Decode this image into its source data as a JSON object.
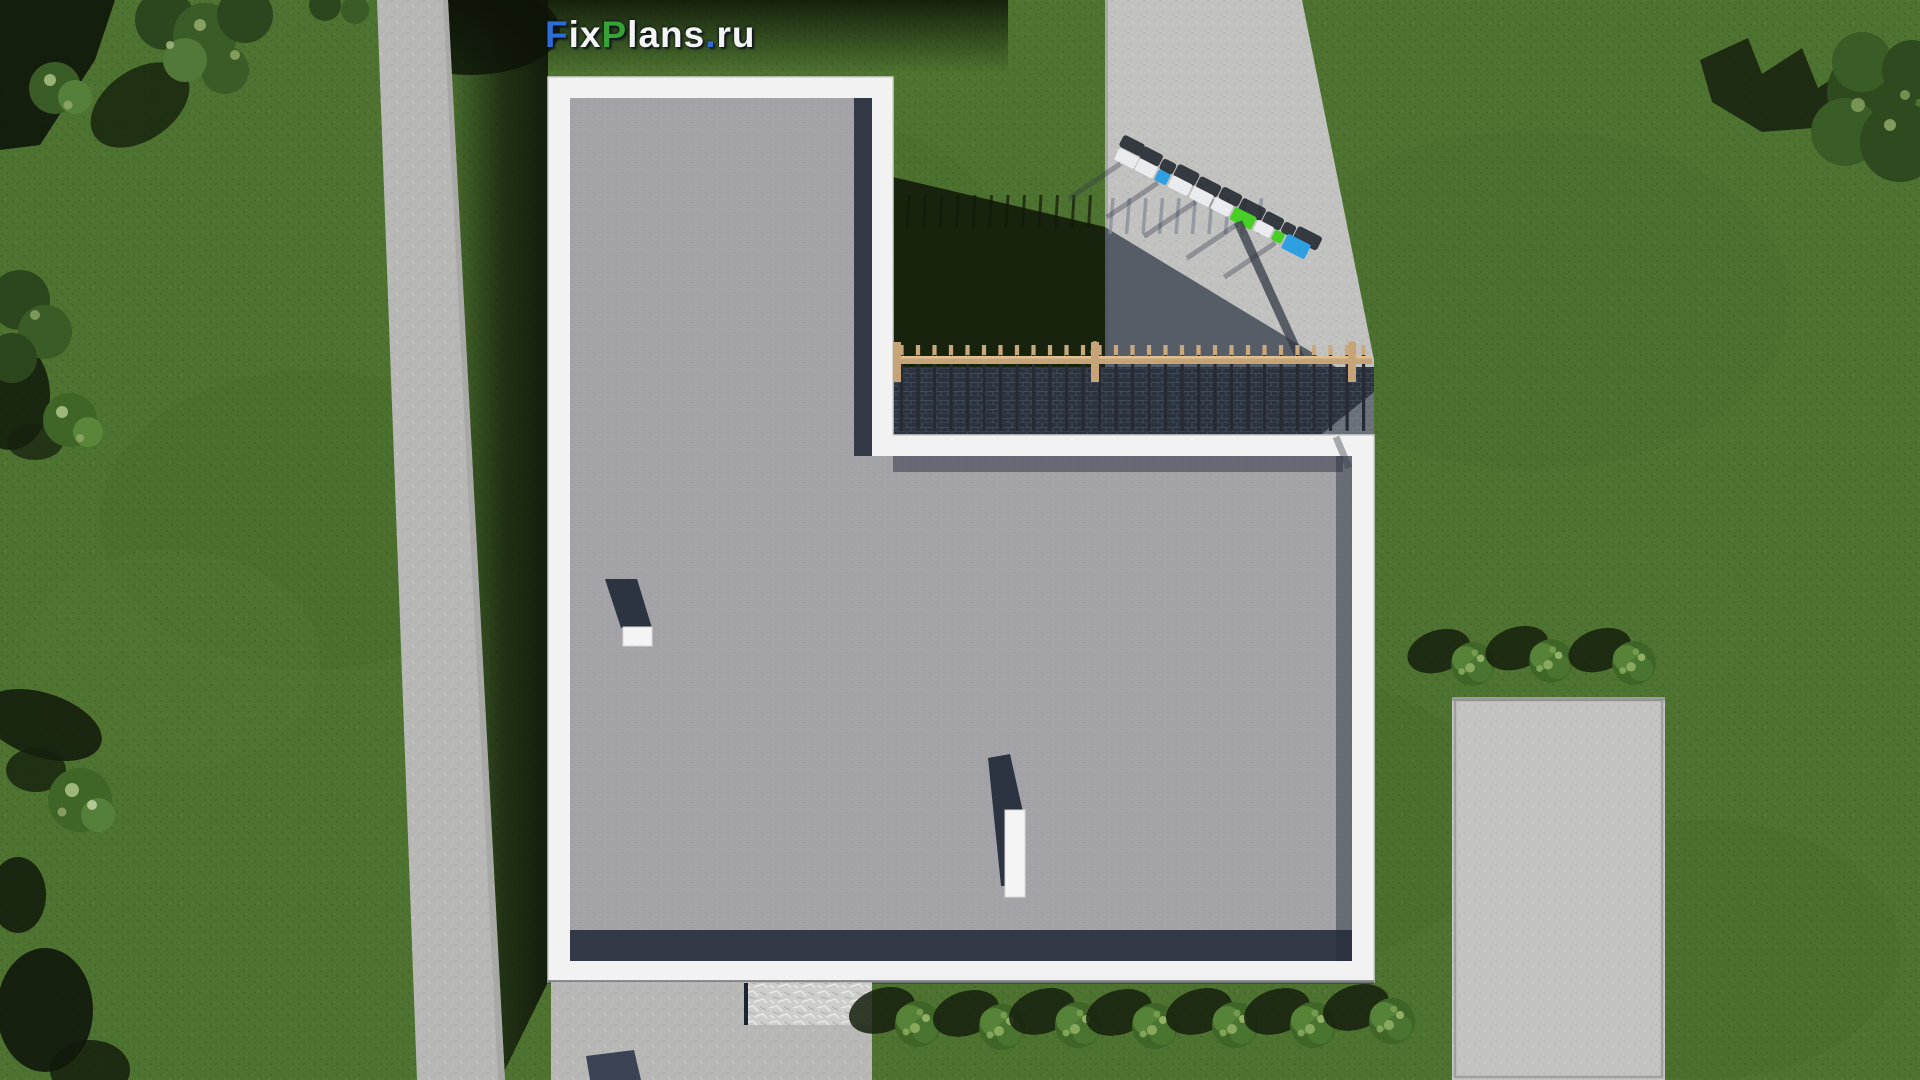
{
  "site": {
    "logo": {
      "segments": [
        {
          "text": "F",
          "color": "#2b6fd6"
        },
        {
          "text": "ix",
          "color": "#f4f4f4"
        },
        {
          "text": "P",
          "color": "#37a336"
        },
        {
          "text": "lans",
          "color": "#f4f4f4"
        },
        {
          "text": ".",
          "color": "#2b6fd6"
        },
        {
          "text": "ru",
          "color": "#f4f4f4"
        }
      ]
    }
  },
  "palette": {
    "grass": "#4e7330",
    "grass_shadow": "#141d0c",
    "path": "#b7b7b5",
    "road": "#c1c1bf",
    "road_shadow": "#474e5b",
    "concrete": "#c3c3c1",
    "roof": "#a5a5a9",
    "roof_shadow": "#232a38",
    "parapet": "#f2f2f2",
    "fence": "#c6a477",
    "stone_dark": "#2c333f",
    "bush": "#3f6527",
    "bush_light": "#8fae63",
    "car_blue": "#2e9fe0",
    "car_green": "#48cf25",
    "car_white": "#e9ebee",
    "logo_blue": "#2b6fd6",
    "logo_green": "#37a336",
    "logo_white": "#f4f4f4"
  },
  "scene": {
    "view": "top-down aerial render of an L-shaped flat-roof house",
    "bottom_bush_count": 7,
    "right_bush_count": 3,
    "parked_car_count": 10,
    "roof_vent_count": 2
  }
}
